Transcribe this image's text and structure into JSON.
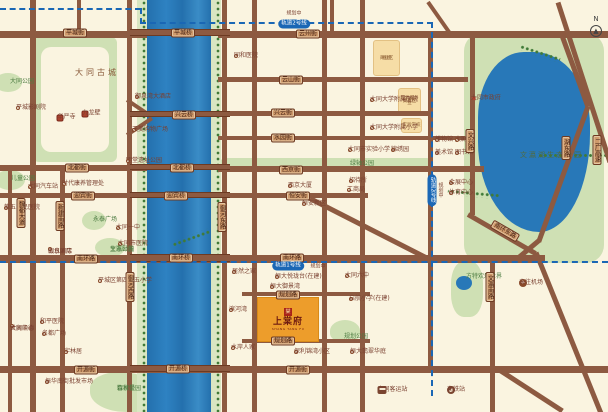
{
  "meta": {
    "width": 608,
    "height": 412
  },
  "colors": {
    "background": "#faf4e0",
    "road": "#8d5a41",
    "river": "#2878b8",
    "park": "#cfe0b4",
    "badge_bg": "#cf9a6b",
    "badge_text": "#3f1d10",
    "metro_blue": "#1a67b5",
    "poi_text": "#7a4030",
    "park_text": "#4e7d43",
    "project_orange": "#ed9d2b",
    "project_text": "#6e1a10",
    "seal_red": "#a92318",
    "orange_block": "#f6dda6"
  },
  "compass": {
    "label": "N",
    "arrow": "▲"
  },
  "metro": {
    "line1": "轨道1号线",
    "line2": "轨道2号线",
    "note": "规划中"
  },
  "project": {
    "seal": "棠",
    "name": "上棠府",
    "caption": "SHANG TANG FU"
  },
  "roads": {
    "h": [
      [
        0,
        31,
        147,
        7
      ],
      [
        218,
        31,
        390,
        7
      ],
      [
        218,
        77,
        250,
        5
      ],
      [
        218,
        111,
        214,
        5
      ],
      [
        218,
        136,
        247,
        4
      ],
      [
        0,
        165,
        147,
        6
      ],
      [
        218,
        166,
        266,
        6
      ],
      [
        0,
        193,
        147,
        5
      ],
      [
        218,
        193,
        150,
        5
      ],
      [
        0,
        255,
        545,
        8
      ],
      [
        242,
        292,
        128,
        4
      ],
      [
        242,
        339,
        128,
        4
      ],
      [
        0,
        366,
        608,
        7
      ]
    ],
    "v": [
      [
        8,
        165,
        247,
        4
      ],
      [
        30,
        0,
        412,
        6
      ],
      [
        60,
        166,
        246,
        5
      ],
      [
        77,
        0,
        37,
        4
      ],
      [
        127,
        0,
        412,
        5
      ],
      [
        222,
        0,
        412,
        5
      ],
      [
        252,
        0,
        412,
        5
      ],
      [
        322,
        0,
        412,
        5
      ],
      [
        360,
        0,
        412,
        5
      ],
      [
        330,
        0,
        33,
        4
      ],
      [
        428,
        33,
        337,
        5
      ],
      [
        470,
        33,
        182,
        5
      ],
      [
        490,
        255,
        157,
        5
      ]
    ],
    "d": [
      [
        428,
        0,
        40,
        55,
        4
      ],
      [
        127,
        98,
        30,
        34,
        4
      ],
      [
        127,
        133,
        30,
        -34,
        4
      ],
      [
        310,
        196,
        135,
        27,
        5
      ],
      [
        558,
        0,
        168,
        72,
        5
      ],
      [
        562,
        33,
        76,
        70,
        5
      ],
      [
        588,
        104,
        144,
        110,
        5
      ],
      [
        539,
        238,
        26,
        140,
        5
      ],
      [
        468,
        212,
        78,
        30,
        5
      ],
      [
        536,
        250,
        175,
        68,
        5
      ],
      [
        497,
        366,
        78,
        33,
        5
      ]
    ]
  },
  "river": {
    "water": [
      147,
      0,
      64,
      412
    ],
    "banks": [
      [
        137,
        0,
        10,
        412
      ],
      [
        211,
        0,
        10,
        412
      ]
    ],
    "trees": [
      [
        142,
        0,
        4,
        412
      ],
      [
        216,
        0,
        4,
        412
      ]
    ],
    "bridges": [
      [
        130,
        29,
        100,
        7
      ],
      [
        130,
        111,
        100,
        6
      ],
      [
        130,
        164,
        100,
        6
      ],
      [
        130,
        192,
        100,
        6
      ],
      [
        130,
        254,
        100,
        8
      ],
      [
        130,
        365,
        100,
        7
      ]
    ]
  },
  "tree_arcs": [
    [
      520,
      44,
      42,
      6,
      18
    ],
    [
      573,
      118,
      6,
      70,
      90
    ],
    [
      474,
      165,
      6,
      52,
      95
    ],
    [
      210,
      228,
      40,
      6,
      160
    ]
  ],
  "parks": [
    {
      "x": 33,
      "y": 37,
      "w": 84,
      "h": 125,
      "r": "6px",
      "inner": [
        41,
        47,
        68,
        105
      ]
    },
    {
      "x": -6,
      "y": 73,
      "w": 28,
      "h": 19,
      "r": "50%"
    },
    {
      "x": -5,
      "y": 170,
      "w": 30,
      "h": 20,
      "r": "50%"
    },
    {
      "x": 82,
      "y": 211,
      "w": 24,
      "h": 19,
      "r": "50%"
    },
    {
      "x": 95,
      "y": 238,
      "w": 30,
      "h": 19,
      "r": "50%"
    },
    {
      "x": 90,
      "y": 372,
      "w": 72,
      "h": 40,
      "r": "40% 60% 30% 50%"
    },
    {
      "x": 220,
      "y": 158,
      "w": 212,
      "h": 11,
      "r": "5px"
    },
    {
      "x": 330,
      "y": 320,
      "w": 30,
      "h": 22,
      "r": "50% 50% 40% 40%"
    },
    {
      "x": 451,
      "y": 261,
      "w": 32,
      "h": 56,
      "r": "40%"
    },
    {
      "x": 464,
      "y": 33,
      "w": 140,
      "h": 230,
      "r": "18px"
    }
  ],
  "lakes": [
    {
      "x": 478,
      "y": 52,
      "w": 112,
      "h": 180,
      "r": "45% 55% 50% 60% / 40% 45% 60% 55%"
    },
    {
      "x": 456,
      "y": 276,
      "w": 16,
      "h": 14,
      "r": "50%"
    }
  ],
  "badges": [
    {
      "t": "平城街",
      "x": 75,
      "y": 33,
      "o": "h"
    },
    {
      "t": "北都街",
      "x": 77,
      "y": 168,
      "o": "h"
    },
    {
      "t": "迎宾街",
      "x": 83,
      "y": 196,
      "o": "h"
    },
    {
      "t": "南环路",
      "x": 86,
      "y": 259,
      "o": "h"
    },
    {
      "t": "开源街",
      "x": 86,
      "y": 370,
      "o": "h"
    },
    {
      "t": "平城桥",
      "x": 183,
      "y": 33,
      "o": "h"
    },
    {
      "t": "兴云桥",
      "x": 184,
      "y": 115,
      "o": "h"
    },
    {
      "t": "北都桥",
      "x": 182,
      "y": 168,
      "o": "h"
    },
    {
      "t": "迎宾桥",
      "x": 176,
      "y": 196,
      "o": "h"
    },
    {
      "t": "南环桥",
      "x": 181,
      "y": 258,
      "o": "h"
    },
    {
      "t": "开源桥",
      "x": 178,
      "y": 369,
      "o": "h"
    },
    {
      "t": "云州街",
      "x": 308,
      "y": 34,
      "o": "h"
    },
    {
      "t": "云山街",
      "x": 291,
      "y": 80,
      "o": "h"
    },
    {
      "t": "兴云街",
      "x": 283,
      "y": 113,
      "o": "h"
    },
    {
      "t": "水园街",
      "x": 283,
      "y": 138,
      "o": "h"
    },
    {
      "t": "西京街",
      "x": 291,
      "y": 170,
      "o": "h"
    },
    {
      "t": "恒安街",
      "x": 298,
      "y": 196,
      "o": "h"
    },
    {
      "t": "南环路",
      "x": 292,
      "y": 258,
      "o": "h"
    },
    {
      "t": "规划路",
      "x": 288,
      "y": 295,
      "o": "h"
    },
    {
      "t": "规划路",
      "x": 283,
      "y": 341,
      "o": "h"
    },
    {
      "t": "开源街",
      "x": 298,
      "y": 370,
      "o": "h"
    },
    {
      "t": "魏都大道",
      "x": 21,
      "y": 213,
      "o": "v"
    },
    {
      "t": "新建南路",
      "x": 60,
      "y": 216,
      "o": "v"
    },
    {
      "t": "御河西路",
      "x": 130,
      "y": 287,
      "o": "v"
    },
    {
      "t": "御河东路",
      "x": 222,
      "y": 217,
      "o": "v"
    },
    {
      "t": "文兴路",
      "x": 470,
      "y": 141,
      "o": "v"
    },
    {
      "t": "文瀛南路",
      "x": 490,
      "y": 287,
      "o": "v"
    },
    {
      "t": "湖东路",
      "x": 566,
      "y": 148,
      "o": "v"
    },
    {
      "t": "二广高速",
      "x": 597,
      "y": 150,
      "o": "v"
    },
    {
      "t": "南环东路",
      "x": 505,
      "y": 231,
      "o": "h",
      "rot": 30
    }
  ],
  "metro_segments": [
    {
      "x": 0,
      "y": 8,
      "len": 141,
      "o": "h"
    },
    {
      "x": 140,
      "y": 8,
      "len": 16,
      "o": "v"
    },
    {
      "x": 140,
      "y": 22,
      "len": 293,
      "o": "h"
    },
    {
      "x": 431,
      "y": 22,
      "len": 374,
      "o": "v"
    },
    {
      "x": 0,
      "y": 261,
      "len": 608,
      "o": "h"
    }
  ],
  "metro_badges": [
    {
      "line": "line2",
      "x": 294,
      "y": 24,
      "o": "h",
      "nx": 294,
      "ny": 13,
      "no": "h"
    },
    {
      "line": "line1",
      "x": 288,
      "y": 266,
      "o": "h",
      "nx": 318,
      "ny": 266,
      "no": "h"
    },
    {
      "line": "line2",
      "x": 432,
      "y": 190,
      "o": "v",
      "nx": 441,
      "ny": 190,
      "no": "v"
    }
  ],
  "blocks": [
    {
      "x": 373,
      "y": 40,
      "w": 27,
      "h": 36,
      "lines": [
        "规划",
        "商业区"
      ]
    },
    {
      "x": 398,
      "y": 88,
      "w": 23,
      "h": 26,
      "lines": [
        "现代服务业",
        "集聚区"
      ]
    },
    {
      "x": 401,
      "y": 118,
      "w": 21,
      "h": 15,
      "lines": [
        "实验学校"
      ]
    }
  ],
  "pois": [
    {
      "t": "大同古城",
      "x": 75,
      "y": 73,
      "i": "none",
      "cls": "big"
    },
    {
      "t": "文瀛湖生态公园",
      "x": 520,
      "y": 155,
      "i": "none",
      "cls": "lake"
    },
    {
      "t": "大同公园",
      "x": 10,
      "y": 82,
      "i": "none",
      "cls": "park"
    },
    {
      "t": "平城影剧院",
      "x": 18,
      "y": 108,
      "i": "dot"
    },
    {
      "t": "御泉湾大酒店",
      "x": 137,
      "y": 97,
      "i": "dot"
    },
    {
      "t": "天美购物广场",
      "x": 134,
      "y": 130,
      "i": "dot"
    },
    {
      "t": "华严寺",
      "x": 60,
      "y": 118,
      "i": "temple"
    },
    {
      "t": "九龙壁",
      "x": 85,
      "y": 114,
      "i": "temple"
    },
    {
      "t": "明堂遗址公园",
      "x": 128,
      "y": 161,
      "i": "dot"
    },
    {
      "t": "儿童公园",
      "x": 11,
      "y": 179,
      "i": "none",
      "cls": "park"
    },
    {
      "t": "大同汽车站",
      "x": 30,
      "y": 187,
      "i": "dot"
    },
    {
      "t": "时代康养管理处",
      "x": 64,
      "y": 184,
      "i": "dot"
    },
    {
      "t": "第五人民医院",
      "x": 6,
      "y": 208,
      "i": "dot"
    },
    {
      "t": "永泰广场",
      "x": 93,
      "y": 220,
      "i": "none",
      "cls": "park"
    },
    {
      "t": "大同一中",
      "x": 118,
      "y": 228,
      "i": "dot"
    },
    {
      "t": "大同市医院",
      "x": 120,
      "y": 244,
      "i": "dot"
    },
    {
      "t": "",
      "lines": [
        "文瀛颐景",
        "生态公园"
      ],
      "x": 110,
      "y": 247,
      "i": "none",
      "cls": "park"
    },
    {
      "t": "",
      "lines": [
        "山水国际",
        "假日酒店"
      ],
      "x": 50,
      "y": 249,
      "i": "dot"
    },
    {
      "t": "平城区第四十五小学",
      "x": 100,
      "y": 281,
      "i": "dot"
    },
    {
      "t": "",
      "lines": [
        "大同凯德",
        "世贸中心"
      ],
      "x": 12,
      "y": 326,
      "i": "dot"
    },
    {
      "t": "和平医院",
      "x": 42,
      "y": 322,
      "i": "dot"
    },
    {
      "t": "名都广场",
      "x": 44,
      "y": 334,
      "i": "dot"
    },
    {
      "t": "宇林居",
      "x": 66,
      "y": 352,
      "i": "dot"
    },
    {
      "t": "振华南街批发市场",
      "x": 47,
      "y": 382,
      "i": "dot"
    },
    {
      "t": "",
      "lines": [
        "智家堡",
        "森林公园"
      ],
      "x": 117,
      "y": 386,
      "i": "none",
      "cls": "park"
    },
    {
      "t": "同和医院",
      "x": 236,
      "y": 56,
      "i": "dot"
    },
    {
      "t": "大同大学附属医院",
      "x": 372,
      "y": 100,
      "i": "dot"
    },
    {
      "t": "大同大学附属小学",
      "x": 372,
      "y": 128,
      "i": "dot"
    },
    {
      "t": "大同市实验小学",
      "x": 350,
      "y": 150,
      "i": "dot"
    },
    {
      "t": "锦绣园",
      "x": 393,
      "y": 150,
      "i": "dot"
    },
    {
      "t": "绿轴公园",
      "x": 350,
      "y": 164,
      "i": "none",
      "cls": "park"
    },
    {
      "t": "西京大厦",
      "x": 290,
      "y": 186,
      "i": "dot"
    },
    {
      "t": "招待所",
      "x": 351,
      "y": 181,
      "i": "dot"
    },
    {
      "t": "工商局",
      "x": 349,
      "y": 190,
      "i": "dot"
    },
    {
      "t": "恒安新区",
      "x": 304,
      "y": 204,
      "i": "dot"
    },
    {
      "t": "居然之家",
      "x": 234,
      "y": 272,
      "i": "dot"
    },
    {
      "t": "滨河湾",
      "x": 231,
      "y": 310,
      "i": "dot"
    },
    {
      "t": "水岸人家",
      "x": 233,
      "y": 348,
      "i": "dot"
    },
    {
      "t": "恒大悦珑台(在建)",
      "x": 277,
      "y": 277,
      "i": "dot"
    },
    {
      "t": "恒大御景湾",
      "x": 272,
      "y": 287,
      "i": "dot"
    },
    {
      "t": "大同六中",
      "x": 347,
      "y": 276,
      "i": "dot"
    },
    {
      "t": "启航小学(在建)",
      "x": 351,
      "y": 299,
      "i": "dot"
    },
    {
      "t": "规划公园",
      "x": 344,
      "y": 337,
      "i": "none",
      "cls": "park"
    },
    {
      "t": "恒大翡翠华庭",
      "x": 352,
      "y": 352,
      "i": "dot"
    },
    {
      "t": "保利锦湾小区",
      "x": 296,
      "y": 352,
      "i": "dot"
    },
    {
      "t": "博物馆",
      "x": 437,
      "y": 140,
      "i": "dot"
    },
    {
      "t": "大剧院",
      "x": 457,
      "y": 140,
      "i": "dot"
    },
    {
      "t": "美术馆",
      "x": 437,
      "y": 153,
      "i": "dot"
    },
    {
      "t": "图书馆",
      "x": 457,
      "y": 153,
      "i": "dot"
    },
    {
      "t": "大同市政府",
      "x": 474,
      "y": 99,
      "i": "star"
    },
    {
      "t": "会展中心",
      "x": 451,
      "y": 183,
      "i": "dot"
    },
    {
      "t": "体育中心",
      "x": 451,
      "y": 193,
      "i": "dot"
    },
    {
      "t": "方特欢乐世界",
      "x": 466,
      "y": 277,
      "i": "none",
      "cls": "park"
    },
    {
      "t": "去往机场",
      "x": 523,
      "y": 283,
      "i": "plane"
    },
    {
      "t": "大同客运站",
      "x": 382,
      "y": 390,
      "i": "bus",
      "side": "right"
    },
    {
      "t": "高铁站",
      "x": 451,
      "y": 390,
      "i": "train"
    }
  ]
}
